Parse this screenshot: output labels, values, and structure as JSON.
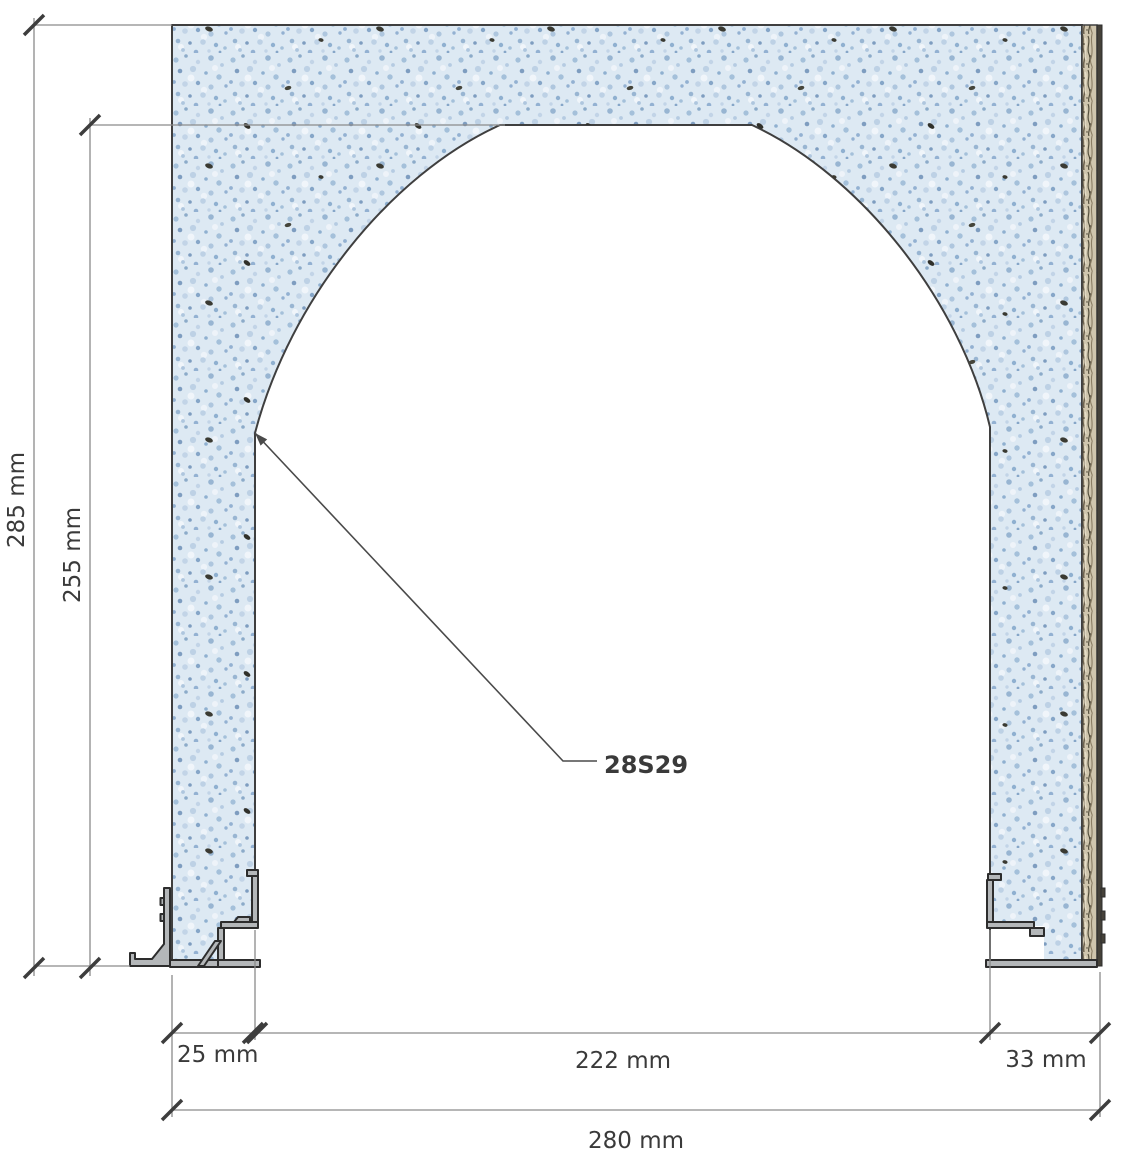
{
  "drawing": {
    "product_label": "28S29",
    "dimensions": {
      "total_height": "285 mm",
      "opening_height": "255 mm",
      "left_jamb_width": "25 mm",
      "opening_width": "222 mm",
      "right_jamb_width": "33 mm",
      "total_width": "280 mm"
    },
    "colors": {
      "wall_fill": "#dde9f3",
      "wall_speckle": "#8fb0d0",
      "insulation_strip": "#cfc5ad",
      "metal_profile": "#b4b7b9",
      "outline": "#3f3f3f",
      "dimension_line": "#8a8a8a",
      "dimension_text": "#3a3a3a"
    }
  }
}
